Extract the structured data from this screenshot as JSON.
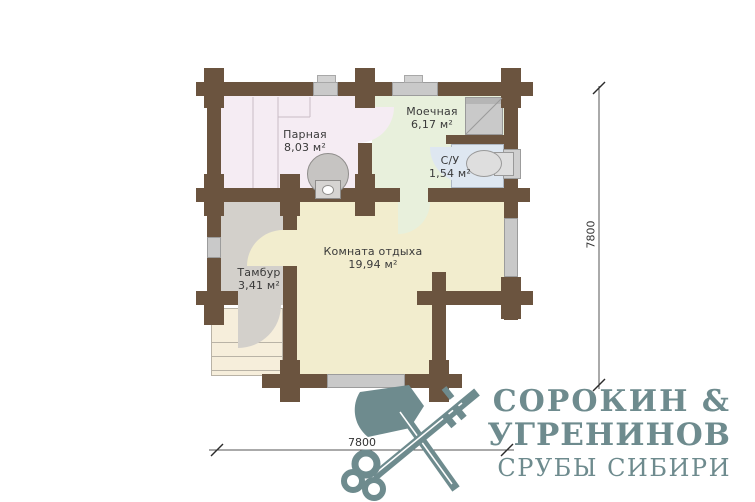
{
  "plan": {
    "rooms": [
      {
        "id": "parnaya",
        "name": "Парная",
        "area": "8,03 м²"
      },
      {
        "id": "moechnaya",
        "name": "Моечная",
        "area": "6,17 м²"
      },
      {
        "id": "su",
        "name": "С/У",
        "area": "1,54 м²"
      },
      {
        "id": "rest",
        "name": "Комната отдыха",
        "area": "19,94 м²"
      },
      {
        "id": "tambur",
        "name": "Тамбур",
        "area": "3,41 м²"
      }
    ],
    "dimensions": {
      "right": "7800",
      "bottom": "7800"
    },
    "fixtures": [
      "stove-icon",
      "shower-icon",
      "toilet-icon",
      "porch-steps"
    ]
  },
  "logo": {
    "line1": "СОРОКИН &",
    "line2": "УГРЕНИНОВ",
    "line3": "СРУБЫ СИБИРИ",
    "icon": "crossed-axe-and-key"
  },
  "colors": {
    "wall": "#6b543f",
    "parnaya": "#f5ecf3",
    "moechnaya": "#e8f0dc",
    "su": "#dee7f1",
    "rest": "#f2edce",
    "tambur": "#d3d0cb",
    "porch": "#f6eedb",
    "window": "#c9c9c9",
    "fixture": "#c6c4c2",
    "fixture_light": "#dedede",
    "label": "#3a3a3a",
    "brand": "#6e8b8e"
  }
}
